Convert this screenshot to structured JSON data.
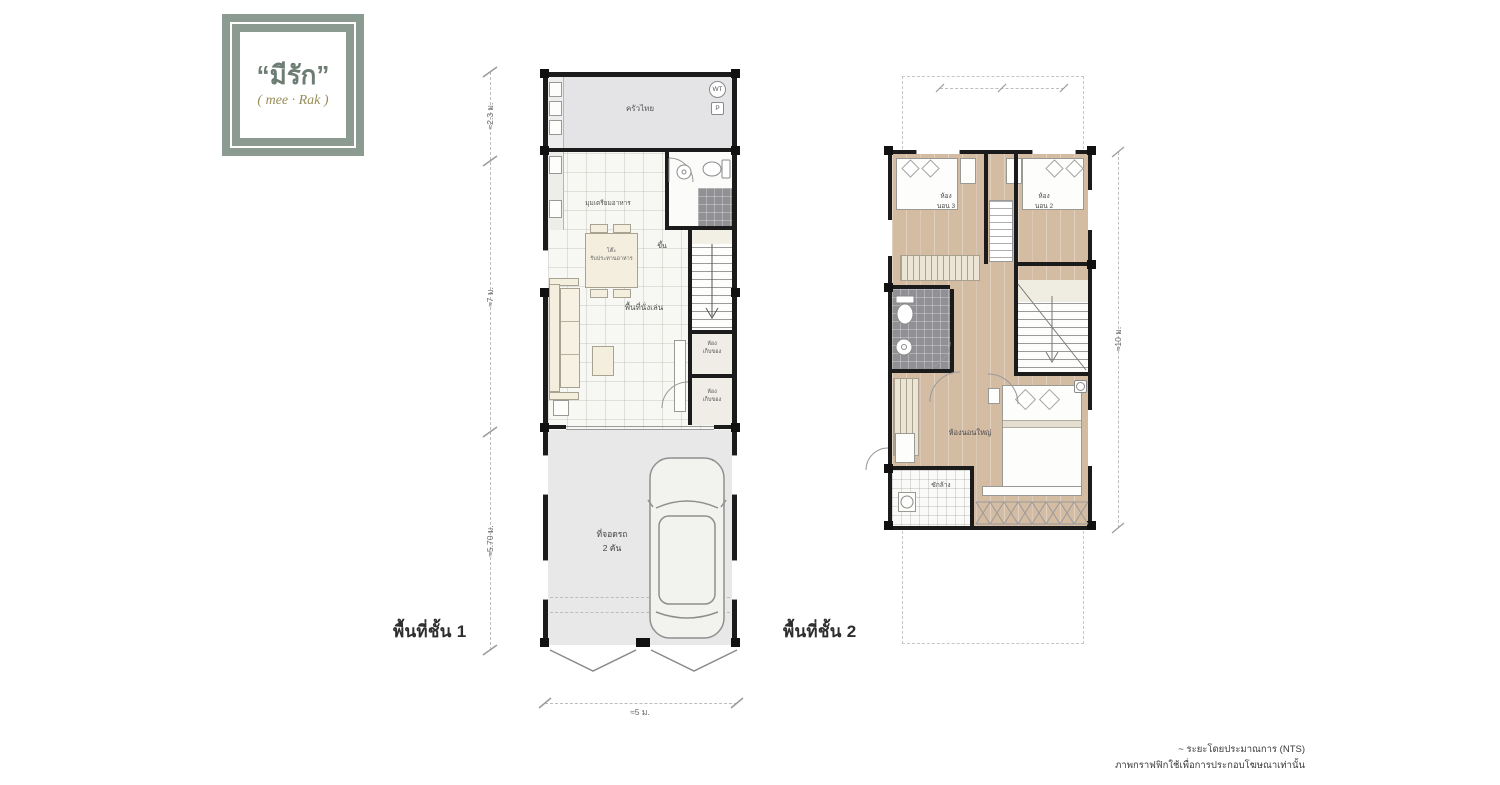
{
  "logo": {
    "thai_name": "“มีรัก”",
    "latin_name": "( mee · Rak )",
    "frame_color": "#8c9b92",
    "thai_color": "#6d7d73",
    "latin_color": "#978c57"
  },
  "floor1": {
    "title": "พื้นที่ชั้น 1",
    "rooms": {
      "kitchen": "ครัวไทย",
      "prep": "มุมเตรียมอาหาร",
      "dining_l1": "โต๊ะ",
      "dining_l2": "รับประทานอาหาร",
      "up": "ขึ้น",
      "living": "พื้นที่นั่งเล่น",
      "storage_l1": "ห้อง",
      "storage_l2": "เก็บของ",
      "parking_l1": "ที่จอดรถ",
      "parking_l2": "2 คัน"
    },
    "tags": {
      "wt": "WT",
      "p": "P"
    },
    "dims": {
      "d1": "≈2.3 ม.",
      "d2": "≈7 ม.",
      "d3": "≈5.70 ม.",
      "w": "≈5 ม."
    }
  },
  "floor2": {
    "title": "พื้นที่ชั้น 2",
    "rooms": {
      "bed3_l1": "ห้อง",
      "bed3_l2": "นอน 3",
      "bed2_l1": "ห้อง",
      "bed2_l2": "นอน 2",
      "master": "ห้องนอนใหญ่",
      "laundry": "ซักล้าง"
    },
    "dims": {
      "h": "≈10 ม."
    }
  },
  "footer": {
    "line1": "~ ระยะโดยประมาณการ (NTS)",
    "line2": "ภาพกราฟฟิกใช้เพื่อการประกอบโฆษณาเท่านั้น"
  },
  "colors": {
    "wall": "#1b1b1b",
    "wood_floor": "#d9c3ac",
    "kitchen_floor": "#e4e4e6",
    "parking_floor": "#e8e8e8",
    "dark_tile": "#919195"
  }
}
